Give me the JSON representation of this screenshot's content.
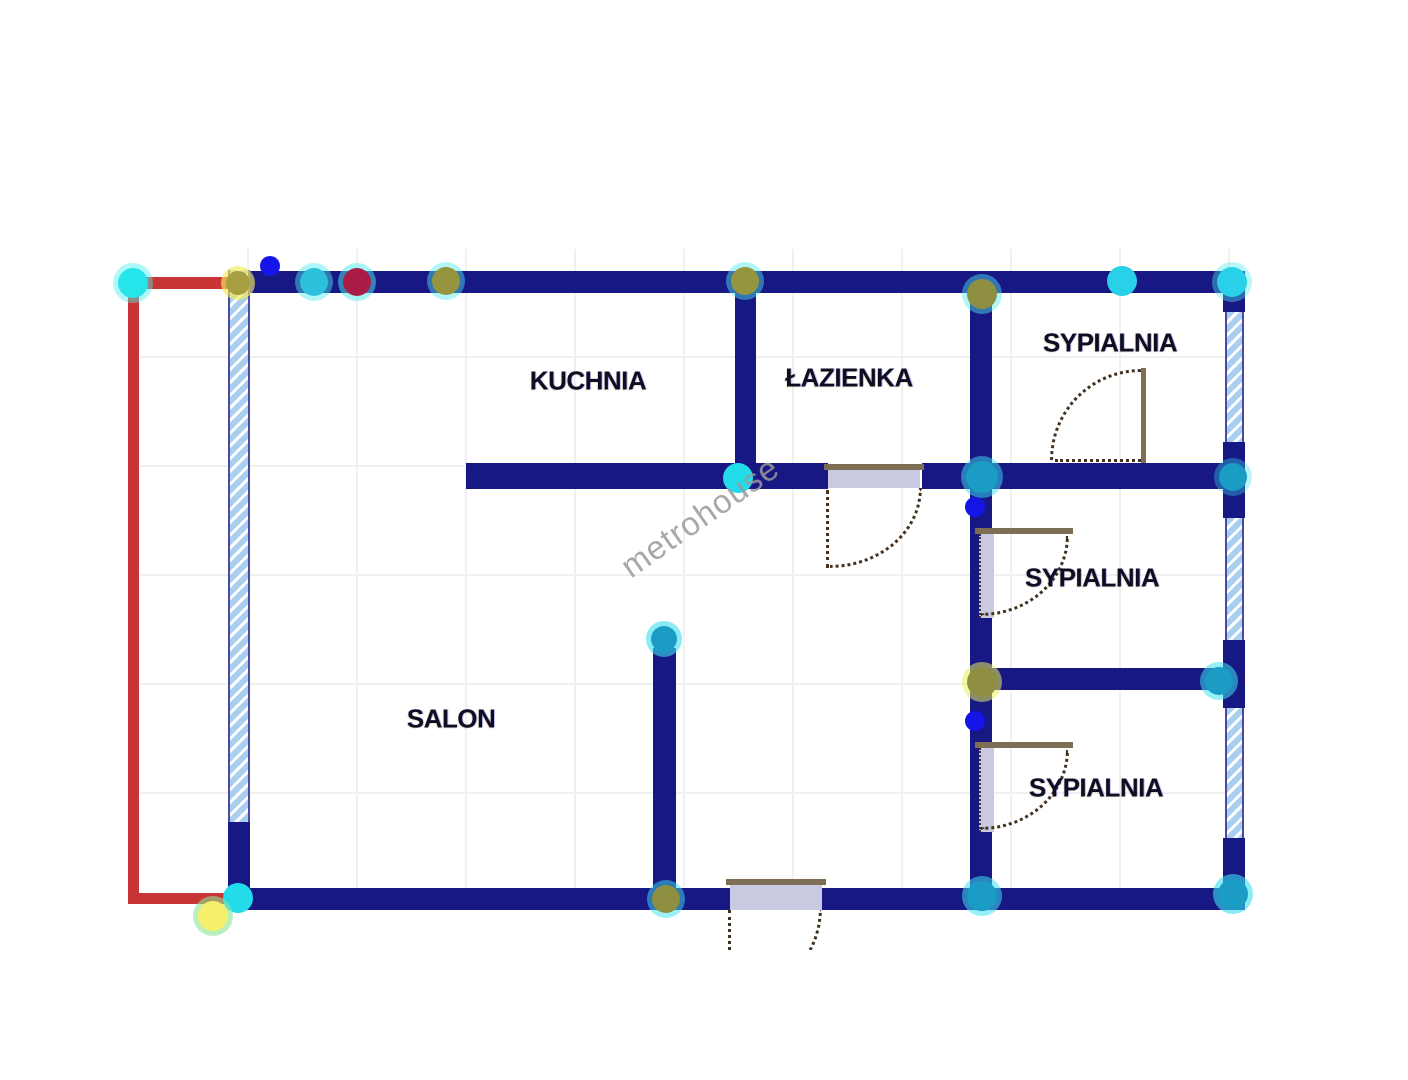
{
  "watermark_text": "metrohouse",
  "rooms": [
    {
      "id": "kuchnia",
      "label": "KUCHNIA",
      "x": 588,
      "y": 381
    },
    {
      "id": "lazienka",
      "label": "ŁAZIENKA",
      "x": 849,
      "y": 378
    },
    {
      "id": "sypialnia-top",
      "label": "SYPIALNIA",
      "x": 1110,
      "y": 343
    },
    {
      "id": "sypialnia-middle",
      "label": "SYPIALNIA",
      "x": 1092,
      "y": 578
    },
    {
      "id": "sypialnia-bottom",
      "label": "SYPIALNIA",
      "x": 1096,
      "y": 788
    },
    {
      "id": "salon",
      "label": "SALON",
      "x": 451,
      "y": 719
    }
  ],
  "nodes": [
    {
      "x": 133,
      "y": 283,
      "r": 15,
      "color": "#25e4ea",
      "ring": "rgba(80,240,240,0.45)"
    },
    {
      "x": 238,
      "y": 283,
      "r": 12,
      "color": "#a8a040",
      "ring": "rgba(245,235,90,0.65)"
    },
    {
      "x": 270,
      "y": 266,
      "r": 10,
      "color": "#1515e8",
      "ring": "none"
    },
    {
      "x": 314,
      "y": 282,
      "r": 14,
      "color": "#2cc0dc",
      "ring": "rgba(80,235,240,0.45)"
    },
    {
      "x": 357,
      "y": 282,
      "r": 14,
      "color": "#a81c45",
      "ring": "rgba(80,235,240,0.5)"
    },
    {
      "x": 446,
      "y": 281,
      "r": 14,
      "color": "#95953f",
      "ring": "rgba(80,235,240,0.45)"
    },
    {
      "x": 745,
      "y": 281,
      "r": 14,
      "color": "#95953f",
      "ring": "rgba(80,235,240,0.45)"
    },
    {
      "x": 982,
      "y": 294,
      "r": 15,
      "color": "#8f8f42",
      "ring": "rgba(80,235,240,0.45)"
    },
    {
      "x": 1122,
      "y": 281,
      "r": 15,
      "color": "#28d0e8",
      "ring": "none"
    },
    {
      "x": 1232,
      "y": 282,
      "r": 15,
      "color": "#28d0e8",
      "ring": "rgba(80,235,240,0.4)"
    },
    {
      "x": 738,
      "y": 478,
      "r": 15,
      "color": "#22dcea",
      "ring": "none"
    },
    {
      "x": 982,
      "y": 477,
      "r": 16,
      "color": "#1a9cc4",
      "ring": "rgba(60,225,240,0.5)"
    },
    {
      "x": 975,
      "y": 507,
      "r": 10,
      "color": "#1515e8",
      "ring": "none"
    },
    {
      "x": 1233,
      "y": 477,
      "r": 14,
      "color": "#1a9cc4",
      "ring": "rgba(60,225,240,0.35)"
    },
    {
      "x": 664,
      "y": 639,
      "r": 13,
      "color": "#1a9cc4",
      "ring": "rgba(60,225,240,0.6)"
    },
    {
      "x": 982,
      "y": 682,
      "r": 15,
      "color": "#8f8f42",
      "ring": "rgba(235,240,90,0.55)"
    },
    {
      "x": 1219,
      "y": 681,
      "r": 14,
      "color": "#1a9cc4",
      "ring": "rgba(60,225,240,0.55)"
    },
    {
      "x": 975,
      "y": 721,
      "r": 10,
      "color": "#1515e8",
      "ring": "none"
    },
    {
      "x": 666,
      "y": 899,
      "r": 14,
      "color": "#8f8f42",
      "ring": "rgba(60,225,240,0.5)"
    },
    {
      "x": 238,
      "y": 898,
      "r": 15,
      "color": "#22dcea",
      "ring": "none"
    },
    {
      "x": 213,
      "y": 916,
      "r": 15,
      "color": "#f5f06a",
      "ring": "rgba(140,230,150,0.6)"
    },
    {
      "x": 982,
      "y": 896,
      "r": 15,
      "color": "#1a9cc4",
      "ring": "rgba(60,225,240,0.55)"
    },
    {
      "x": 1233,
      "y": 894,
      "r": 15,
      "color": "#1a9cc4",
      "ring": "rgba(60,225,240,0.6)"
    }
  ],
  "colors": {
    "wall": "#181884",
    "red": "#c93434",
    "window": "#a9ceef",
    "lintel": "#7d6e55",
    "door_fill": "#c9c9e2",
    "dash": "#43321f",
    "label": "#0e0e22",
    "watermark": "#9a9a9a"
  }
}
